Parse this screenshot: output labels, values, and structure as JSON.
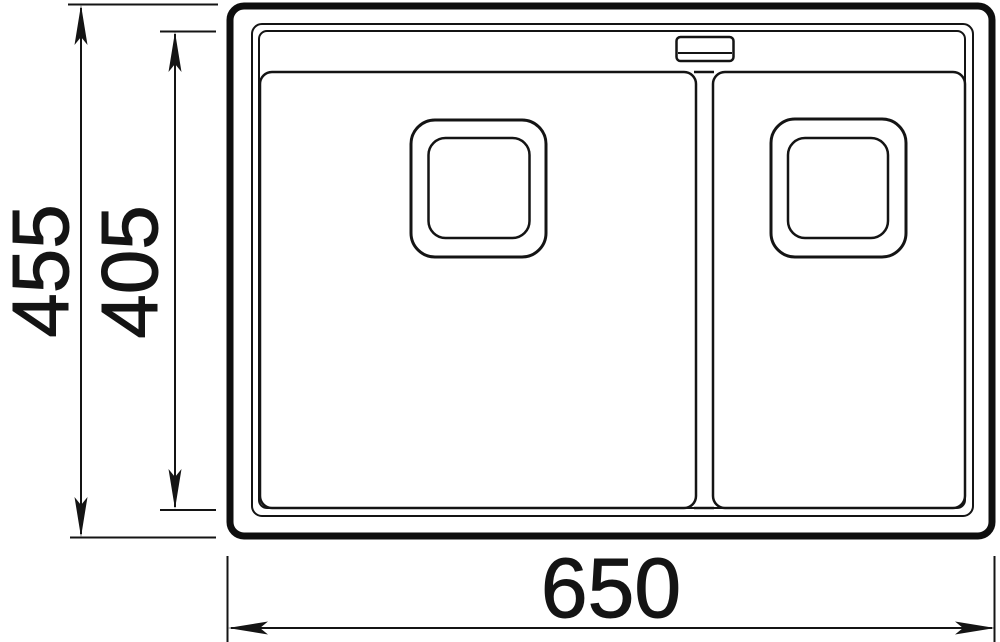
{
  "drawing": {
    "subject": "double-bowl-sink-top-view",
    "background_color": "#ffffff",
    "line_color": "#141414",
    "dimensions": {
      "overall_width": {
        "label": "650"
      },
      "overall_depth": {
        "label": "455"
      },
      "inner_depth": {
        "label": "405"
      }
    }
  }
}
